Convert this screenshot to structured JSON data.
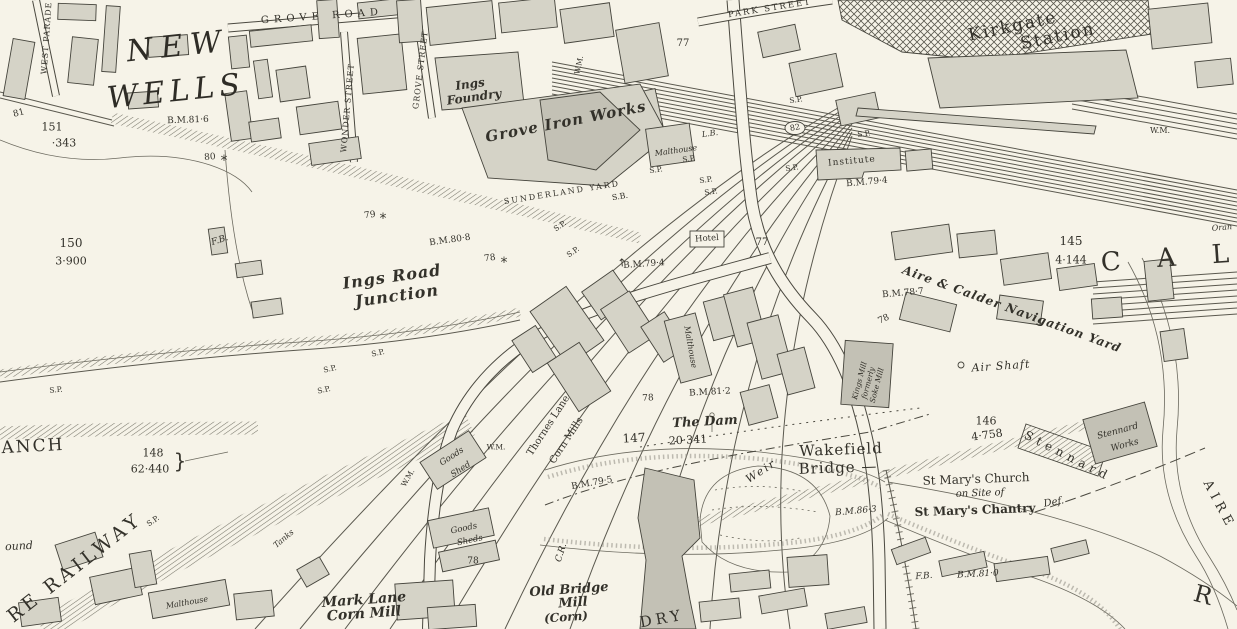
{
  "map": {
    "title": "Ordnance Survey town plan — Wakefield, Kirkgate Station & Ings Road Junction",
    "colors": {
      "paper": "#f6f3e8",
      "ink": "#33312a",
      "building_fill": "#d5d3c7",
      "building_dark": "#c3c1b5",
      "hatch": "#7a786c"
    },
    "labels": [
      {
        "n": "grove-road",
        "t": "GROVE ROAD",
        "x": 322,
        "y": 17,
        "r": -4,
        "s": 10,
        "c": "caps",
        "ls": 5
      },
      {
        "n": "park-street",
        "t": "PARK STREET",
        "x": 770,
        "y": 9,
        "r": -9,
        "s": 8.5,
        "c": "caps",
        "ls": 2
      },
      {
        "n": "west-parade",
        "t": "WEST PARADE",
        "x": 47,
        "y": 38,
        "r": -86,
        "s": 8,
        "c": "caps",
        "ls": 1
      },
      {
        "n": "wonder-street",
        "t": "WONDER STREET",
        "x": 348,
        "y": 108,
        "r": -85,
        "s": 8,
        "c": "caps",
        "ls": 1
      },
      {
        "n": "grove-street",
        "t": "GROVE STREET",
        "x": 421,
        "y": 70,
        "r": -83,
        "s": 8,
        "c": "caps",
        "ls": 1
      },
      {
        "n": "new-wells-1",
        "t": "NEW",
        "x": 178,
        "y": 47,
        "r": -6,
        "s": 30,
        "c": "bigit",
        "ls": 8
      },
      {
        "n": "new-wells-2",
        "t": "WELLS",
        "x": 176,
        "y": 92,
        "r": -6,
        "s": 30,
        "c": "bigit",
        "ls": 5
      },
      {
        "n": "bm-81-6",
        "t": "B.M.81·6",
        "x": 188,
        "y": 121,
        "r": -2,
        "s": 9,
        "c": "ser"
      },
      {
        "n": "num-81",
        "t": "81",
        "x": 19,
        "y": 114,
        "r": -15,
        "s": 9,
        "c": "ser"
      },
      {
        "n": "num-151",
        "t": "151",
        "x": 52,
        "y": 127,
        "r": 0,
        "s": 11,
        "c": "ser"
      },
      {
        "n": "num-343",
        "t": "·343",
        "x": 64,
        "y": 143,
        "r": 0,
        "s": 11,
        "c": "ser"
      },
      {
        "n": "num-80",
        "t": "80",
        "x": 210,
        "y": 158,
        "r": -5,
        "s": 9,
        "c": "ser"
      },
      {
        "n": "star-80",
        "t": "*",
        "x": 224,
        "y": 161,
        "r": 0,
        "s": 14,
        "c": "mk"
      },
      {
        "n": "bm-80-8",
        "t": "B.M.80·8",
        "x": 450,
        "y": 241,
        "r": -8,
        "s": 9,
        "c": "ser"
      },
      {
        "n": "num-78-a",
        "t": "78",
        "x": 490,
        "y": 259,
        "r": -8,
        "s": 9,
        "c": "ser"
      },
      {
        "n": "star-78",
        "t": "*",
        "x": 504,
        "y": 263,
        "r": 0,
        "s": 14,
        "c": "mk"
      },
      {
        "n": "num-79",
        "t": "79",
        "x": 370,
        "y": 216,
        "r": -8,
        "s": 9,
        "c": "ser"
      },
      {
        "n": "star-79",
        "t": "*",
        "x": 383,
        "y": 219,
        "r": 0,
        "s": 14,
        "c": "mk"
      },
      {
        "n": "fb-1",
        "t": "F.B.",
        "x": 220,
        "y": 241,
        "r": -18,
        "s": 9,
        "c": "it"
      },
      {
        "n": "num-150",
        "t": "150",
        "x": 71,
        "y": 243,
        "r": 0,
        "s": 12,
        "c": "ser"
      },
      {
        "n": "num-3-900",
        "t": "3·900",
        "x": 71,
        "y": 261,
        "r": 0,
        "s": 11,
        "c": "ser"
      },
      {
        "n": "ings-foundry-1",
        "t": "Ings",
        "x": 470,
        "y": 84,
        "r": -8,
        "s": 12,
        "c": "bit"
      },
      {
        "n": "ings-foundry-2",
        "t": "Foundry",
        "x": 474,
        "y": 97,
        "r": -8,
        "s": 12,
        "c": "bit"
      },
      {
        "n": "grove-iron-works",
        "t": "Grove Iron Works",
        "x": 566,
        "y": 122,
        "r": -11,
        "s": 15,
        "c": "bit",
        "ls": 1
      },
      {
        "n": "malthouse-a",
        "t": "Malthouse",
        "x": 676,
        "y": 151,
        "r": -8,
        "s": 8,
        "c": "it"
      },
      {
        "n": "lb",
        "t": "L.B.",
        "x": 710,
        "y": 134,
        "r": -8,
        "s": 8,
        "c": "it"
      },
      {
        "n": "sunderland-yard",
        "t": "SUNDERLAND YARD",
        "x": 562,
        "y": 193,
        "r": -9,
        "s": 8,
        "c": "caps",
        "ls": 2
      },
      {
        "n": "sb",
        "t": "S.B.",
        "x": 620,
        "y": 197,
        "r": -9,
        "s": 8,
        "c": "ser"
      },
      {
        "n": "wm-a",
        "t": "W.M.",
        "x": 579,
        "y": 65,
        "r": -78,
        "s": 7.5,
        "c": "ser"
      },
      {
        "n": "num-77-a",
        "t": "77",
        "x": 683,
        "y": 44,
        "r": 0,
        "s": 10,
        "c": "ser"
      },
      {
        "n": "kirkgate",
        "t": "Kirkgate",
        "x": 1013,
        "y": 27,
        "r": -12,
        "s": 17,
        "c": "serspc",
        "ls": 2
      },
      {
        "n": "station",
        "t": "Station",
        "x": 1058,
        "y": 37,
        "r": -12,
        "s": 17,
        "c": "serspc",
        "ls": 2
      },
      {
        "n": "institute",
        "t": "Institute",
        "x": 852,
        "y": 162,
        "r": -5,
        "s": 9,
        "c": "ser",
        "ls": 1
      },
      {
        "n": "bm-79-4-a",
        "t": "B.M.79·4",
        "x": 867,
        "y": 183,
        "r": -5,
        "s": 9,
        "c": "ser"
      },
      {
        "n": "wm-b",
        "t": "W.M.",
        "x": 1160,
        "y": 131,
        "r": 0,
        "s": 8,
        "c": "ser"
      },
      {
        "n": "sp-a",
        "t": "S.P.",
        "x": 560,
        "y": 226,
        "r": -35,
        "s": 7.5,
        "c": "ser"
      },
      {
        "n": "sp-b",
        "t": "S.P.",
        "x": 573,
        "y": 252,
        "r": -35,
        "s": 7.5,
        "c": "ser"
      },
      {
        "n": "sp-c",
        "t": "S.P.",
        "x": 378,
        "y": 353,
        "r": -12,
        "s": 7.5,
        "c": "ser"
      },
      {
        "n": "sp-d",
        "t": "S.P.",
        "x": 330,
        "y": 369,
        "r": -12,
        "s": 7.5,
        "c": "ser"
      },
      {
        "n": "sp-e",
        "t": "S.P.",
        "x": 324,
        "y": 390,
        "r": -12,
        "s": 7.5,
        "c": "ser"
      },
      {
        "n": "sp-f",
        "t": "S.P.",
        "x": 56,
        "y": 390,
        "r": -5,
        "s": 7.5,
        "c": "ser"
      },
      {
        "n": "sp-g",
        "t": "S.P.",
        "x": 153,
        "y": 521,
        "r": -35,
        "s": 7.5,
        "c": "ser"
      },
      {
        "n": "sp-h",
        "t": "S.P.",
        "x": 689,
        "y": 159,
        "r": -8,
        "s": 7.5,
        "c": "ser"
      },
      {
        "n": "sp-i",
        "t": "S.P.",
        "x": 656,
        "y": 170,
        "r": -8,
        "s": 7.5,
        "c": "ser"
      },
      {
        "n": "sp-j",
        "t": "S.P.",
        "x": 706,
        "y": 180,
        "r": -8,
        "s": 7.5,
        "c": "ser"
      },
      {
        "n": "sp-k",
        "t": "S.P.",
        "x": 711,
        "y": 192,
        "r": -8,
        "s": 7.5,
        "c": "ser"
      },
      {
        "n": "sp-l",
        "t": "S.P.",
        "x": 792,
        "y": 168,
        "r": -8,
        "s": 7.5,
        "c": "ser"
      },
      {
        "n": "sp-m",
        "t": "S.P.",
        "x": 796,
        "y": 100,
        "r": -8,
        "s": 7.5,
        "c": "ser"
      },
      {
        "n": "sp-n",
        "t": "S.P.",
        "x": 864,
        "y": 134,
        "r": -8,
        "s": 7.5,
        "c": "ser"
      },
      {
        "n": "hotel",
        "t": "Hotel",
        "x": 707,
        "y": 239,
        "r": -4,
        "s": 8.5,
        "c": "ser"
      },
      {
        "n": "num-77-b",
        "t": "77",
        "x": 762,
        "y": 243,
        "r": 0,
        "s": 10,
        "c": "ser"
      },
      {
        "n": "num-82",
        "t": "82",
        "x": 795,
        "y": 128,
        "r": -10,
        "s": 8,
        "c": "ser"
      },
      {
        "n": "bm-79-4-b",
        "t": "B.M.79·4",
        "x": 644,
        "y": 265,
        "r": -4,
        "s": 9,
        "c": "ser"
      },
      {
        "n": "bm-arrow",
        "t": "↑",
        "x": 622,
        "y": 263,
        "r": -5,
        "s": 11,
        "c": "mk"
      },
      {
        "n": "ings-road",
        "t": "Ings Road",
        "x": 392,
        "y": 277,
        "r": -8,
        "s": 16,
        "c": "bit",
        "ls": 1
      },
      {
        "n": "junction",
        "t": "Junction",
        "x": 397,
        "y": 296,
        "r": -8,
        "s": 16,
        "c": "bit",
        "ls": 1
      },
      {
        "n": "bm-78-7",
        "t": "B.M.78·7",
        "x": 903,
        "y": 294,
        "r": -5,
        "s": 9,
        "c": "ser"
      },
      {
        "n": "num-78-b",
        "t": "78",
        "x": 884,
        "y": 320,
        "r": -25,
        "s": 9,
        "c": "ser"
      },
      {
        "n": "num-145",
        "t": "145",
        "x": 1071,
        "y": 241,
        "r": 0,
        "s": 12,
        "c": "ser"
      },
      {
        "n": "num-4-144",
        "t": "4·144",
        "x": 1071,
        "y": 260,
        "r": 0,
        "s": 11,
        "c": "ser"
      },
      {
        "n": "cal",
        "t": "C A L",
        "x": 1172,
        "y": 258,
        "r": -4,
        "s": 26,
        "c": "serspc",
        "ls": 14
      },
      {
        "n": "navigation-yard",
        "t": "Aire & Calder Navigation Yard",
        "x": 1012,
        "y": 309,
        "r": 20,
        "s": 12,
        "c": "bit",
        "ls": 1
      },
      {
        "n": "air-shaft",
        "t": "Air Shaft",
        "x": 1001,
        "y": 366,
        "r": -4,
        "s": 11,
        "c": "it",
        "ls": 1
      },
      {
        "n": "num-146",
        "t": "146",
        "x": 986,
        "y": 421,
        "r": 0,
        "s": 11,
        "c": "ser"
      },
      {
        "n": "num-4-758",
        "t": "4·758",
        "x": 987,
        "y": 435,
        "r": -8,
        "s": 11,
        "c": "ser"
      },
      {
        "n": "stennard-diag",
        "t": "Stennard",
        "x": 1068,
        "y": 456,
        "r": 27,
        "s": 12,
        "c": "serspc",
        "ls": 5
      },
      {
        "n": "stennard-works-1",
        "t": "Stennard",
        "x": 1118,
        "y": 432,
        "r": -15,
        "s": 9,
        "c": "it"
      },
      {
        "n": "stennard-works-2",
        "t": "Works",
        "x": 1125,
        "y": 446,
        "r": -15,
        "s": 9,
        "c": "it"
      },
      {
        "n": "wakefield",
        "t": "Wakefield",
        "x": 841,
        "y": 450,
        "r": -2,
        "s": 15,
        "c": "ser",
        "ls": 1
      },
      {
        "n": "bridge",
        "t": "Bridge —",
        "x": 838,
        "y": 468,
        "r": -2,
        "s": 15,
        "c": "ser",
        "ls": 1
      },
      {
        "n": "bm-86-3",
        "t": "B.M.86·3",
        "x": 856,
        "y": 512,
        "r": -5,
        "s": 9,
        "c": "it"
      },
      {
        "n": "st-marys-church",
        "t": "St Mary's Church",
        "x": 976,
        "y": 479,
        "r": -2,
        "s": 12,
        "c": "ser"
      },
      {
        "n": "on-site-of",
        "t": "on Site of",
        "x": 980,
        "y": 494,
        "r": -2,
        "s": 10,
        "c": "it"
      },
      {
        "n": "st-marys-chantry",
        "t": "St Mary's Chantry",
        "x": 975,
        "y": 510,
        "r": -2,
        "s": 12,
        "c": "got"
      },
      {
        "n": "def",
        "t": "Def.",
        "x": 1054,
        "y": 503,
        "r": -10,
        "s": 10,
        "c": "it"
      },
      {
        "n": "fb-2",
        "t": "F.B.",
        "x": 924,
        "y": 577,
        "r": -5,
        "s": 9,
        "c": "it"
      },
      {
        "n": "bm-81-0",
        "t": "B.M.81·0",
        "x": 978,
        "y": 575,
        "r": -3,
        "s": 9,
        "c": "it"
      },
      {
        "n": "aire",
        "t": "AIRE",
        "x": 1219,
        "y": 505,
        "r": 62,
        "s": 13,
        "c": "serspc",
        "ls": 5
      },
      {
        "n": "river-r",
        "t": "R",
        "x": 1203,
        "y": 595,
        "r": 15,
        "s": 24,
        "c": "serspc"
      },
      {
        "n": "the-dam",
        "t": "The Dam",
        "x": 705,
        "y": 422,
        "r": -3,
        "s": 13,
        "c": "bit"
      },
      {
        "n": "num-147",
        "t": "147",
        "x": 634,
        "y": 438,
        "r": -3,
        "s": 12,
        "c": "ser"
      },
      {
        "n": "num-20-341",
        "t": "20·341",
        "x": 688,
        "y": 440,
        "r": -3,
        "s": 11,
        "c": "ser"
      },
      {
        "n": "bm-79-5",
        "t": "B.M.79·5",
        "x": 592,
        "y": 484,
        "r": -10,
        "s": 9,
        "c": "ser"
      },
      {
        "n": "cr",
        "t": "C.R.",
        "x": 562,
        "y": 553,
        "r": -72,
        "s": 9,
        "c": "it"
      },
      {
        "n": "weir",
        "t": "Weir",
        "x": 761,
        "y": 471,
        "r": -33,
        "s": 11,
        "c": "it",
        "ls": 2
      },
      {
        "n": "goods-shed-1a",
        "t": "Goods",
        "x": 452,
        "y": 457,
        "r": -33,
        "s": 8.5,
        "c": "it"
      },
      {
        "n": "goods-shed-1b",
        "t": "Shed",
        "x": 461,
        "y": 470,
        "r": -33,
        "s": 8.5,
        "c": "it"
      },
      {
        "n": "goods-sheds-2a",
        "t": "Goods",
        "x": 464,
        "y": 529,
        "r": -12,
        "s": 8.5,
        "c": "it"
      },
      {
        "n": "goods-sheds-2b",
        "t": "Sheds",
        "x": 470,
        "y": 541,
        "r": -12,
        "s": 8.5,
        "c": "it"
      },
      {
        "n": "num-78-c",
        "t": "78",
        "x": 473,
        "y": 562,
        "r": 0,
        "s": 9,
        "c": "ser"
      },
      {
        "n": "wm-c",
        "t": "W.M.",
        "x": 496,
        "y": 447,
        "r": 0,
        "s": 7.5,
        "c": "ser"
      },
      {
        "n": "wm-d",
        "t": "W.M.",
        "x": 408,
        "y": 478,
        "r": -60,
        "s": 7.5,
        "c": "ser"
      },
      {
        "n": "thornes-lane-1",
        "t": "Thornes Lane",
        "x": 549,
        "y": 426,
        "r": -57,
        "s": 10,
        "c": "ser"
      },
      {
        "n": "thornes-lane-2",
        "t": "Corn Mills",
        "x": 567,
        "y": 441,
        "r": -57,
        "s": 10,
        "c": "ser"
      },
      {
        "n": "old-bridge-1",
        "t": "Old Bridge",
        "x": 569,
        "y": 590,
        "r": -4,
        "s": 13,
        "c": "bit"
      },
      {
        "n": "old-bridge-2",
        "t": "Mill",
        "x": 573,
        "y": 603,
        "r": -4,
        "s": 13,
        "c": "bit"
      },
      {
        "n": "old-bridge-3",
        "t": "(Corn)",
        "x": 566,
        "y": 617,
        "r": -4,
        "s": 12,
        "c": "bit"
      },
      {
        "n": "dry",
        "t": "DRY",
        "x": 662,
        "y": 619,
        "r": -10,
        "s": 15,
        "c": "caps",
        "ls": 4
      },
      {
        "n": "mark-lane-1",
        "t": "Mark Lane",
        "x": 364,
        "y": 600,
        "r": -4,
        "s": 14,
        "c": "bit"
      },
      {
        "n": "mark-lane-2",
        "t": "Corn Mill",
        "x": 364,
        "y": 614,
        "r": -4,
        "s": 14,
        "c": "bit"
      },
      {
        "n": "malthouse-b",
        "t": "Malthouse",
        "x": 187,
        "y": 603,
        "r": -10,
        "s": 8,
        "c": "it"
      },
      {
        "n": "tanks",
        "t": "Tanks",
        "x": 284,
        "y": 539,
        "r": -40,
        "s": 8,
        "c": "it"
      },
      {
        "n": "anch",
        "t": "ANCH",
        "x": 33,
        "y": 447,
        "r": -3,
        "s": 17,
        "c": "caps",
        "ls": 2
      },
      {
        "n": "num-148",
        "t": "148",
        "x": 153,
        "y": 453,
        "r": 0,
        "s": 11,
        "c": "ser"
      },
      {
        "n": "num-62-440",
        "t": "62·440",
        "x": 150,
        "y": 469,
        "r": 0,
        "s": 11,
        "c": "ser"
      },
      {
        "n": "brace-148",
        "t": "}",
        "x": 180,
        "y": 461,
        "r": 0,
        "s": 20,
        "c": "mk"
      },
      {
        "n": "re-railway",
        "t": "RE RAILWAY",
        "x": 75,
        "y": 568,
        "r": -38,
        "s": 19,
        "c": "caps",
        "ls": 4
      },
      {
        "n": "ound",
        "t": "ound",
        "x": 19,
        "y": 546,
        "r": -3,
        "s": 11,
        "c": "it"
      },
      {
        "n": "kings-mill",
        "t": "Kings Mill\nformerly\nSoke Mill",
        "x": 868,
        "y": 383,
        "r": -75,
        "s": 7.5,
        "c": "stack"
      },
      {
        "n": "bm-81-2",
        "t": "B.M.81·2",
        "x": 710,
        "y": 393,
        "r": -3,
        "s": 9,
        "c": "ser"
      },
      {
        "n": "num-78-d",
        "t": "78",
        "x": 648,
        "y": 399,
        "r": -3,
        "s": 9,
        "c": "ser"
      },
      {
        "n": "malthouse-c",
        "t": "Malthouse",
        "x": 690,
        "y": 347,
        "r": 80,
        "s": 8,
        "c": "it"
      },
      {
        "n": "oran",
        "t": "Oran",
        "x": 1222,
        "y": 228,
        "r": -5,
        "s": 8,
        "c": "it"
      }
    ]
  }
}
